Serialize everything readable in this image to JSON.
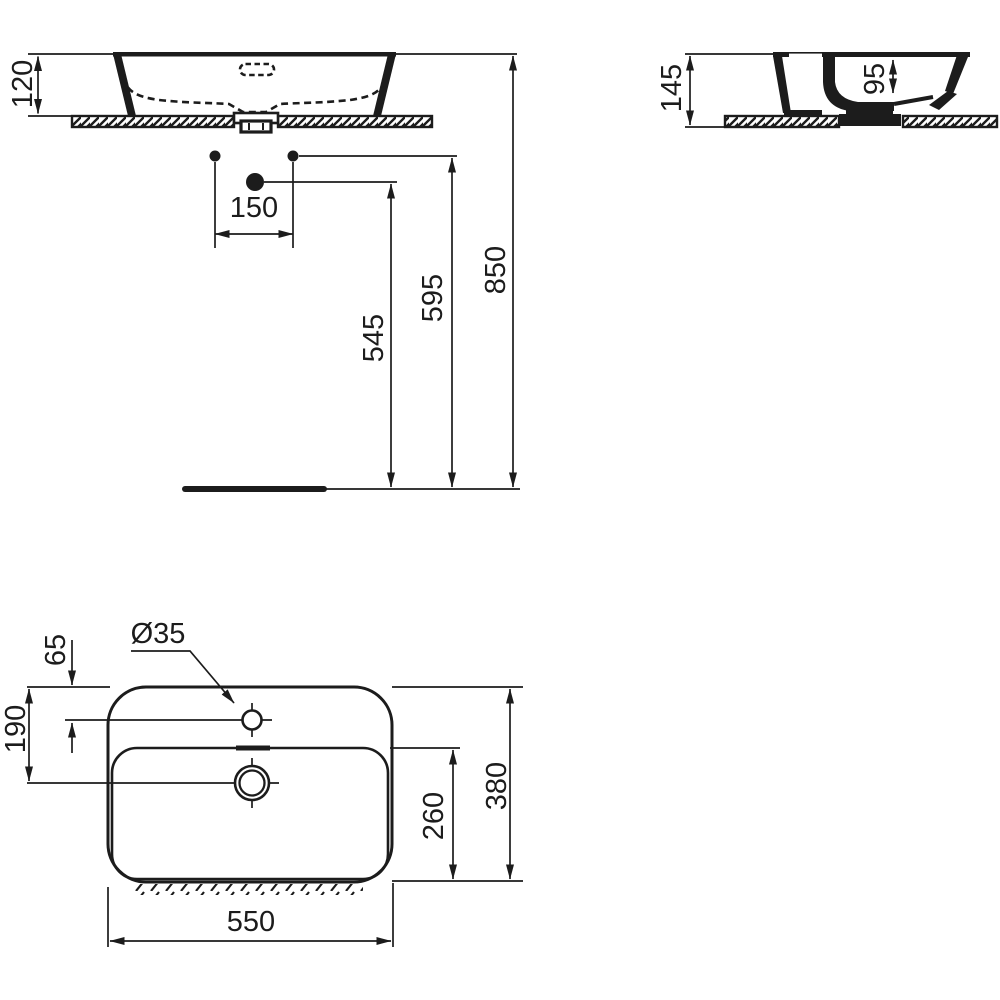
{
  "front_view": {
    "counter_thickness": "120",
    "tap_hole_spacing": "150",
    "drain_outlet_height": "545",
    "supply_height": "595",
    "rim_height": "850"
  },
  "side_view": {
    "basin_height": "145",
    "bowl_depth": "95"
  },
  "plan_view": {
    "tap_hole_diameter": "Ø35",
    "tap_hole_offset": "65",
    "drain_center_offset": "190",
    "inner_bowl_depth": "260",
    "overall_depth": "380",
    "overall_width": "550"
  }
}
